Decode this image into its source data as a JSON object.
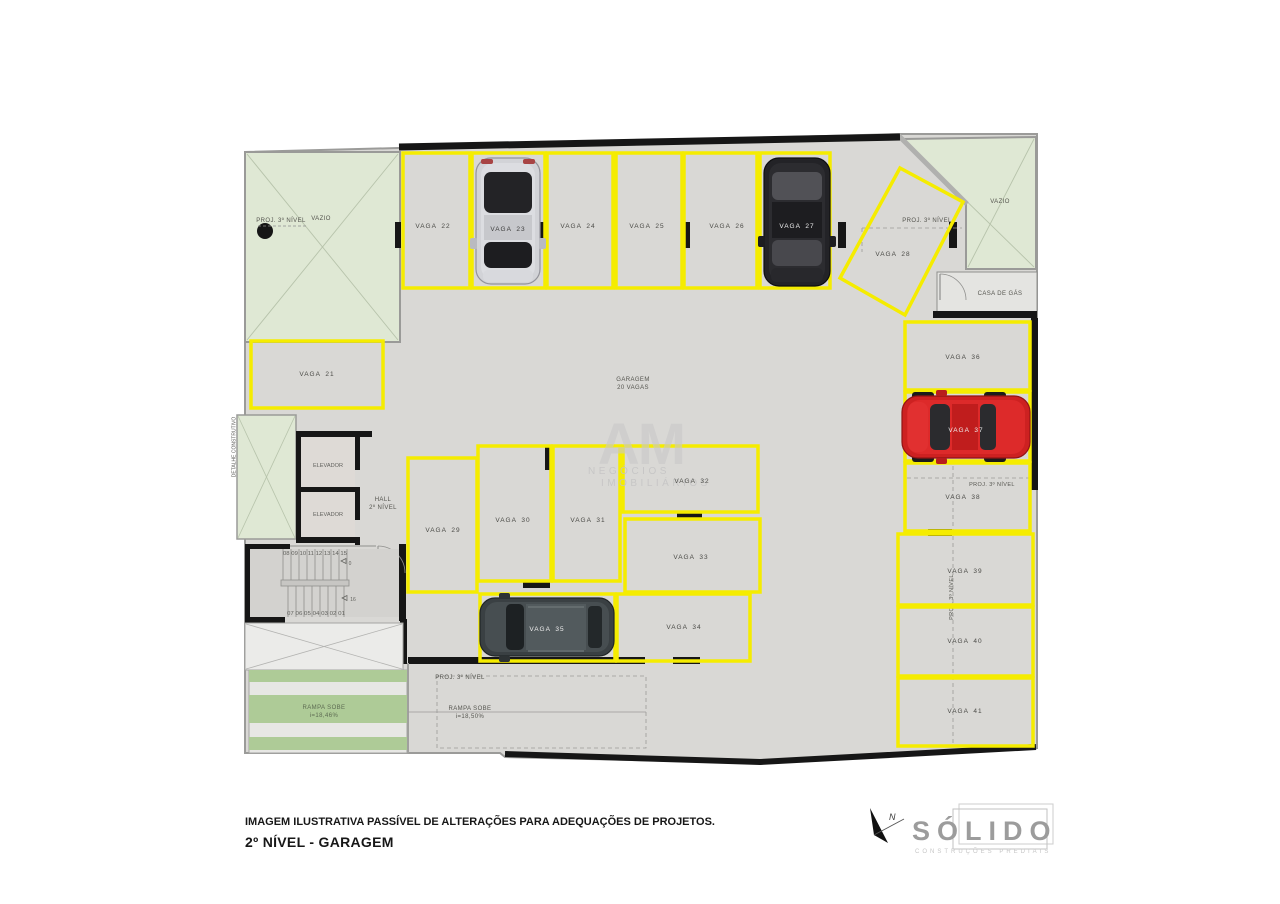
{
  "document": {
    "disclaimer": "IMAGEM ILUSTRATIVA PASSÍVEL DE ALTERAÇÕES PARA ADEQUAÇÕES DE PROJETOS.",
    "level_title": "2º NÍVEL - GARAGEM"
  },
  "branding": {
    "company": "SÓLIDO",
    "company_subtitle": "CONSTRUÇÕES PREDIAIS",
    "north": "N"
  },
  "watermark": {
    "initials": "AM",
    "line1": "NEGÓCIOS",
    "line2": "IMOBILIÁRIOS"
  },
  "plan": {
    "garage_title": "GARAGEM",
    "garage_subtitle": "20 VAGAS",
    "vazio": "VAZIO",
    "proj_3_nivel": "PROJ. 3º NÍVEL",
    "casa_de_gas": "CASA DE GÁS",
    "elevador": "ELEVADOR",
    "hall_line1": "HALL",
    "hall_line2": "2º NÍVEL",
    "detalhe_construtivo": "DETALHE CONSTRUTIVO",
    "stairs_upper": "08 09 10 11 12 13 14 15",
    "stairs_lower": "07 06 05 04 03 02 01",
    "stairs_mark_upper": "0",
    "stairs_mark_lower": "16",
    "ramp_left_line1": "RAMPA SOBE",
    "ramp_left_line2": "i=18,46%",
    "ramp_right_line1": "RAMPA SOBE",
    "ramp_right_line2": "i=18,50%",
    "spaces": [
      "VAGA 21",
      "VAGA 22",
      "VAGA 23",
      "VAGA 24",
      "VAGA 25",
      "VAGA 26",
      "VAGA 27",
      "VAGA 28",
      "VAGA 29",
      "VAGA 30",
      "VAGA 31",
      "VAGA 32",
      "VAGA 33",
      "VAGA 34",
      "VAGA 35",
      "VAGA 36",
      "VAGA 37",
      "VAGA 38",
      "VAGA 39",
      "VAGA 40",
      "VAGA 41"
    ],
    "cars": [
      {
        "space": "VAGA 23",
        "color": "silver"
      },
      {
        "space": "VAGA 27",
        "color": "black"
      },
      {
        "space": "VAGA 35",
        "color": "dark-gray"
      },
      {
        "space": "VAGA 37",
        "color": "red"
      }
    ]
  },
  "colors": {
    "space_outline": "#f5ec00",
    "floor": "#d9d8d5",
    "void_green": "#dfe8d4",
    "ramp_green": "#aecb97",
    "wall": "#161616"
  }
}
